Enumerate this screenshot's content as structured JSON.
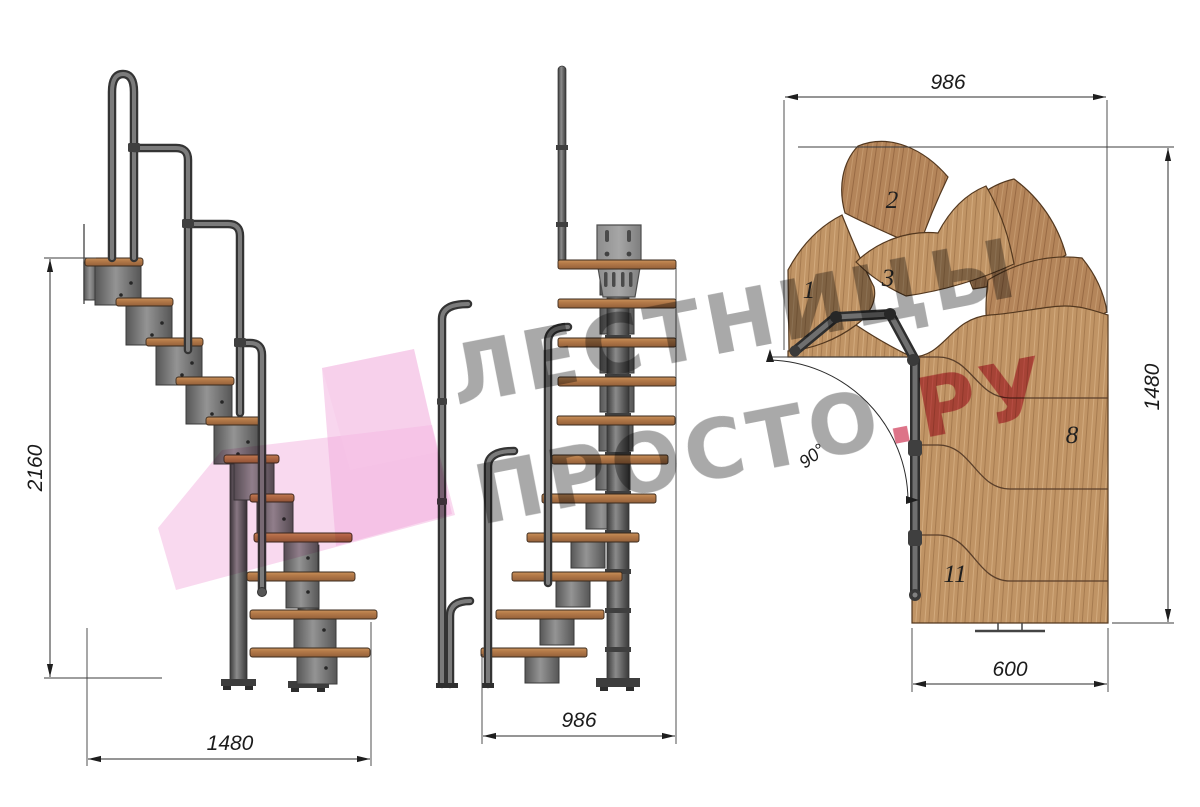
{
  "watermark": {
    "line1": "ЛЕСТНИЦЫ",
    "line2_gray": "ПРОСТО",
    "line2_accent": ".РУ"
  },
  "side_view": {
    "height_dim": "2160",
    "run_dim": "1480"
  },
  "front_view": {
    "width_dim": "986"
  },
  "plan_view": {
    "width_dim": "986",
    "depth_dim": "1480",
    "flight_width_dim": "600",
    "turn_angle": "90°",
    "step_labels": [
      "1",
      "2",
      "3",
      "8",
      "11"
    ]
  },
  "colors": {
    "accent_pink": "#d6556e",
    "watermark_gray": "#979797",
    "logo_blush": "#f0a5da",
    "wood": "#bb8a5f",
    "metal": "#787878",
    "dimension_ink": "#1b1b1b"
  }
}
